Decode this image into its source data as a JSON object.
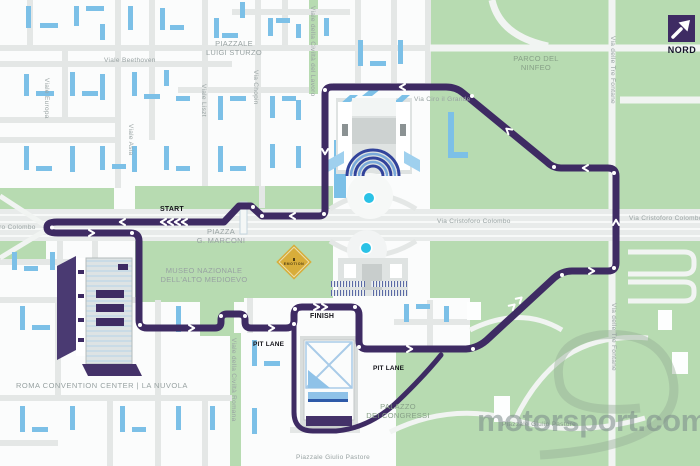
{
  "compass": {
    "label": "NORD"
  },
  "watermark": {
    "text": "motorsport.com"
  },
  "track": {
    "start": "START",
    "finish": "FINISH",
    "pit_lane_left": "PIT LANE",
    "pit_lane_right": "PIT LANE"
  },
  "logo": {
    "text": "EMOTION"
  },
  "streets": {
    "piazzale_luigi_sturzo": {
      "line1": "PIAZZALE",
      "line2": "LUIGI STURZO"
    },
    "viale_beethoven": "Viale Beethoven",
    "viale_europa": "Viale Europa",
    "viale_asia": "Viale Asia",
    "viale_liszt": "Viale Liszt",
    "via_chopin": "Via Chopin",
    "viale_della_civilta_del_lavoro": "Viale della Civiltà del Lavoro",
    "via_ciro_il_grande": "Via Ciro il Grande",
    "via_delle_tre_fontane_north": "Via delle Tre Fontane",
    "via_delle_tre_fontane_south": "Via delle Tre Fontane",
    "via_cristoforo_colombo_west": "Via Cristoforo Colombo",
    "via_cristoforo_colombo_center": "Via Cristoforo Colombo",
    "via_cristoforo_colombo_east": "Via Cristoforo Colombo",
    "viale_della_civilta_romana": "Viale della Civiltà Romana",
    "piazzale_giulio_pastore": "Piazzale Giulio Pastore",
    "piazzale_giulio_pastore_2": "Piazzale Giulio Pastore"
  },
  "places": {
    "parco_del_ninfeo": {
      "line1": "PARCO DEL",
      "line2": "NINFEO"
    },
    "piazza_marconi": {
      "line1": "PIAZZA",
      "line2": "G. MARCONI"
    },
    "museo": {
      "line1": "MUSEO NAZIONALE",
      "line2": "DELL'ALTO MEDIOEVO"
    },
    "roma_convention_center": "ROMA CONVENTION CENTER | LA NUVOLA",
    "palazzo_dei_congressi": {
      "line1": "PALAZZO",
      "line2": "DEI CONGRESSI"
    }
  },
  "colors": {
    "track_purple": "#3e2b63",
    "park_green": "#b7dbb1",
    "building_blue": "#7cc0e7",
    "fountain_cyan": "#2ac2e6",
    "diamond_yellow": "#d8ad3a",
    "street_gray": "#e4e7e6"
  }
}
